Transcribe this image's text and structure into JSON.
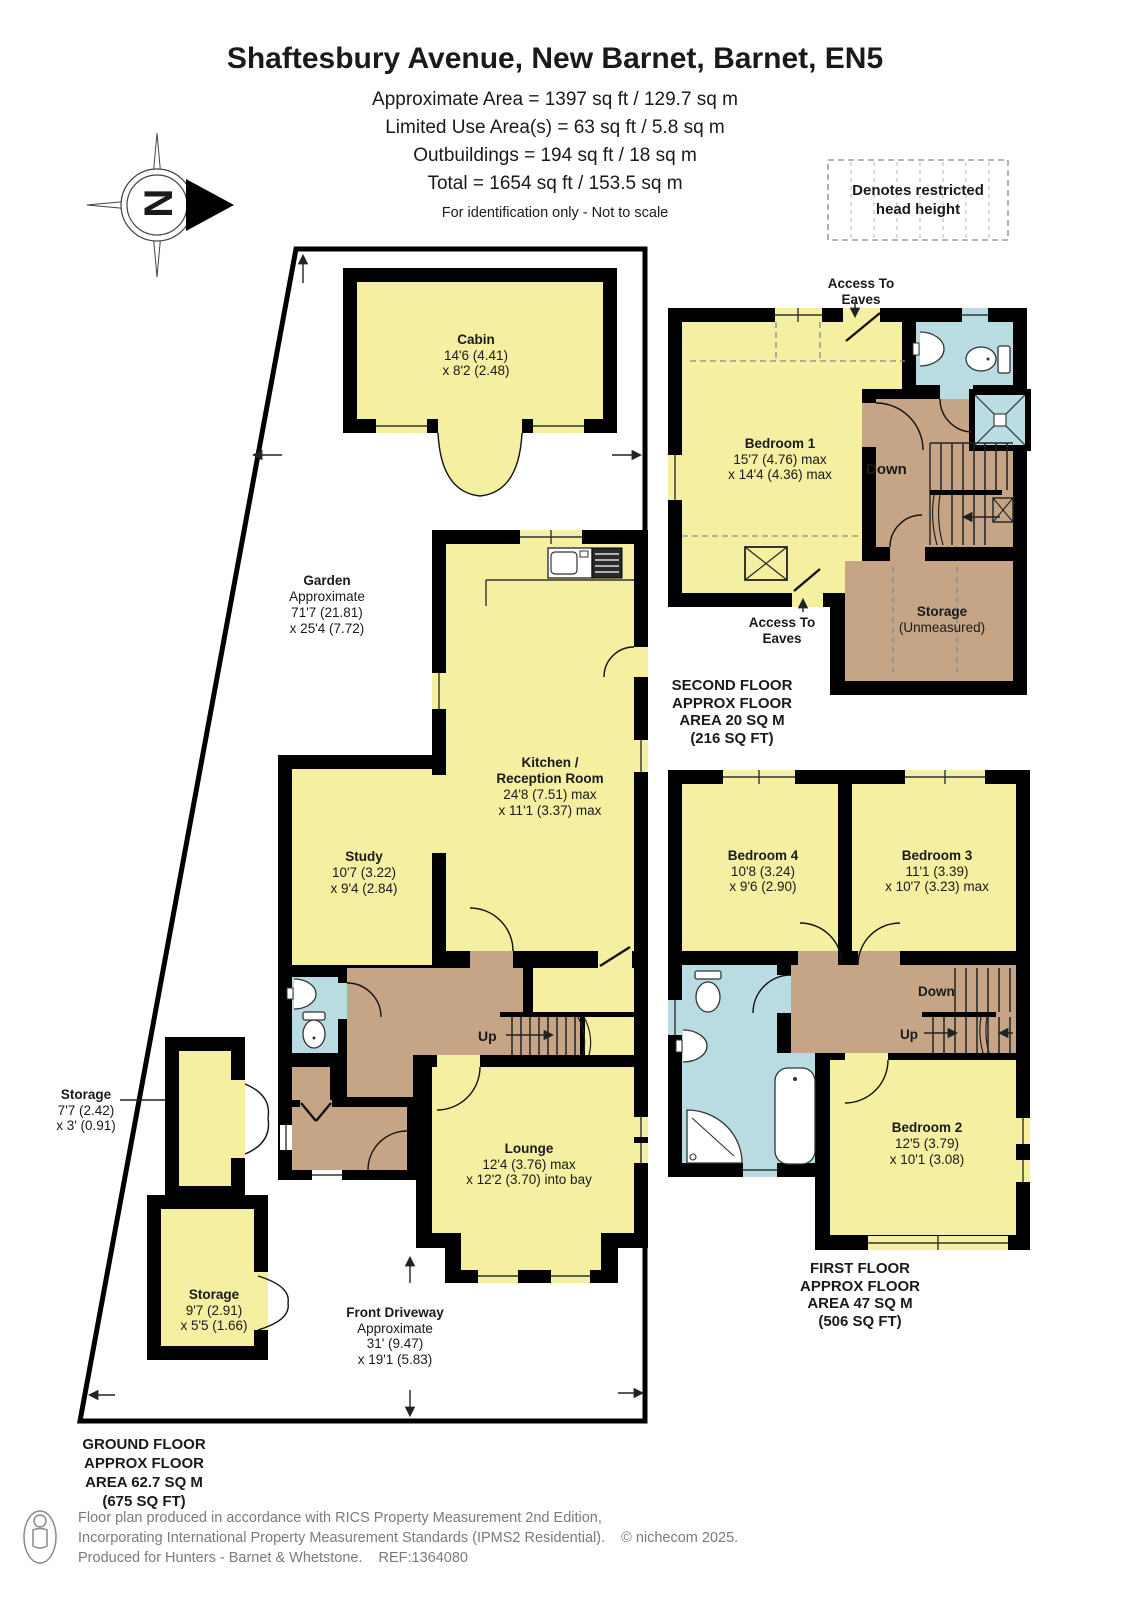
{
  "header": {
    "title": "Shaftesbury Avenue, New Barnet, Barnet, EN5",
    "line1": "Approximate Area = 1397 sq ft / 129.7 sq m",
    "line2": "Limited Use Area(s) = 63 sq ft / 5.8 sq m",
    "line3": "Outbuildings = 194 sq ft / 18 sq m",
    "line4": "Total = 1654 sq ft / 153.5 sq m",
    "disclaimer": "For identification only - Not to scale",
    "compass_letter": "N",
    "legend_line1": "Denotes restricted",
    "legend_line2": "head height"
  },
  "ground_floor": {
    "floor_label_1": "GROUND FLOOR",
    "floor_label_2": "APPROX FLOOR",
    "floor_label_3": "AREA 62.7 SQ M",
    "floor_label_4": "(675 SQ FT)",
    "cabin": {
      "name": "Cabin",
      "dim1": "14'6 (4.41)",
      "dim2": "x 8'2 (2.48)"
    },
    "garden": {
      "name": "Garden",
      "approx": "Approximate",
      "dim1": "71'7 (21.81)",
      "dim2": "x 25'4 (7.72)"
    },
    "kitchen": {
      "name1": "Kitchen /",
      "name2": "Reception Room",
      "dim1": "24'8 (7.51) max",
      "dim2": "x 11'1 (3.37) max"
    },
    "study": {
      "name": "Study",
      "dim1": "10'7 (3.22)",
      "dim2": "x 9'4 (2.84)"
    },
    "lounge": {
      "name": "Lounge",
      "dim1": "12'4 (3.76) max",
      "dim2": "x 12'2 (3.70) into bay"
    },
    "storage_small": {
      "name": "Storage",
      "dim1": "7'7 (2.42)",
      "dim2": "x 3' (0.91)"
    },
    "storage_large": {
      "name": "Storage",
      "dim1": "9'7 (2.91)",
      "dim2": "x 5'5 (1.66)"
    },
    "driveway": {
      "name": "Front Driveway",
      "approx": "Approximate",
      "dim1": "31' (9.47)",
      "dim2": "x 19'1 (5.83)"
    },
    "up_label": "Up"
  },
  "first_floor": {
    "floor_label_1": "FIRST FLOOR",
    "floor_label_2": "APPROX FLOOR",
    "floor_label_3": "AREA 47 SQ M",
    "floor_label_4": "(506 SQ FT)",
    "bedroom2": {
      "name": "Bedroom 2",
      "dim1": "12'5 (3.79)",
      "dim2": "x 10'1 (3.08)"
    },
    "bedroom3": {
      "name": "Bedroom 3",
      "dim1": "11'1 (3.39)",
      "dim2": "x 10'7 (3.23) max"
    },
    "bedroom4": {
      "name": "Bedroom 4",
      "dim1": "10'8 (3.24)",
      "dim2": "x 9'6 (2.90)"
    },
    "up_label": "Up",
    "down_label": "Down"
  },
  "second_floor": {
    "floor_label_1": "SECOND FLOOR",
    "floor_label_2": "APPROX FLOOR",
    "floor_label_3": "AREA 20 SQ M",
    "floor_label_4": "(216 SQ FT)",
    "bedroom1": {
      "name": "Bedroom 1",
      "dim1": "15'7 (4.76) max",
      "dim2": "x 14'4 (4.36) max"
    },
    "storage": {
      "name": "Storage",
      "dim1": "(Unmeasured)"
    },
    "access_eaves_top": {
      "line1": "Access To",
      "line2": "Eaves"
    },
    "access_eaves_bottom": {
      "line1": "Access To",
      "line2": "Eaves"
    },
    "down_label": "Down"
  },
  "footer": {
    "line1": "Floor plan produced in accordance with RICS Property Measurement 2nd Edition,",
    "line2": "Incorporating International Property Measurement Standards (IPMS2 Residential).",
    "copyright": "© nichecom 2025.",
    "line3": "Produced for Hunters - Barnet & Whetstone.",
    "ref": "REF:1364080"
  },
  "colors": {
    "room_yellow": "#F4EFA1",
    "bathroom_blue": "#B9DBE2",
    "hall_tan": "#C5A586",
    "wall_black": "#000000"
  }
}
